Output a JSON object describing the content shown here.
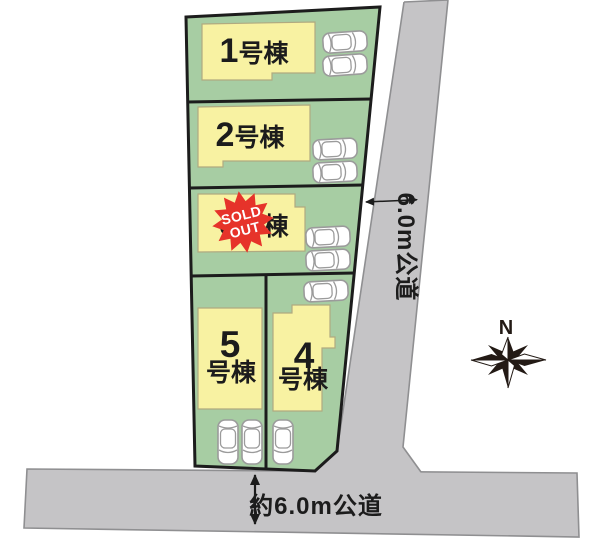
{
  "lots": [
    {
      "number": "1",
      "suffix": "号棟"
    },
    {
      "number": "2",
      "suffix": "号棟"
    },
    {
      "number": "3",
      "suffix": "号棟",
      "sold_out": {
        "line1": "SOLD",
        "line2": "OUT"
      }
    },
    {
      "number": "4",
      "suffix": "号棟"
    },
    {
      "number": "5",
      "suffix": "号棟"
    }
  ],
  "roads": {
    "side": {
      "label": "6.0m公道"
    },
    "bottom": {
      "label": "約6.0m公道"
    }
  },
  "compass": {
    "north_label": "N"
  },
  "colors": {
    "lot_green": "#a7cda3",
    "building_yellow": "#f8f2a2",
    "road_gray": "#c5c4c6",
    "sold_out_red": "#e6332a",
    "outline_black": "#1c1c1c"
  }
}
